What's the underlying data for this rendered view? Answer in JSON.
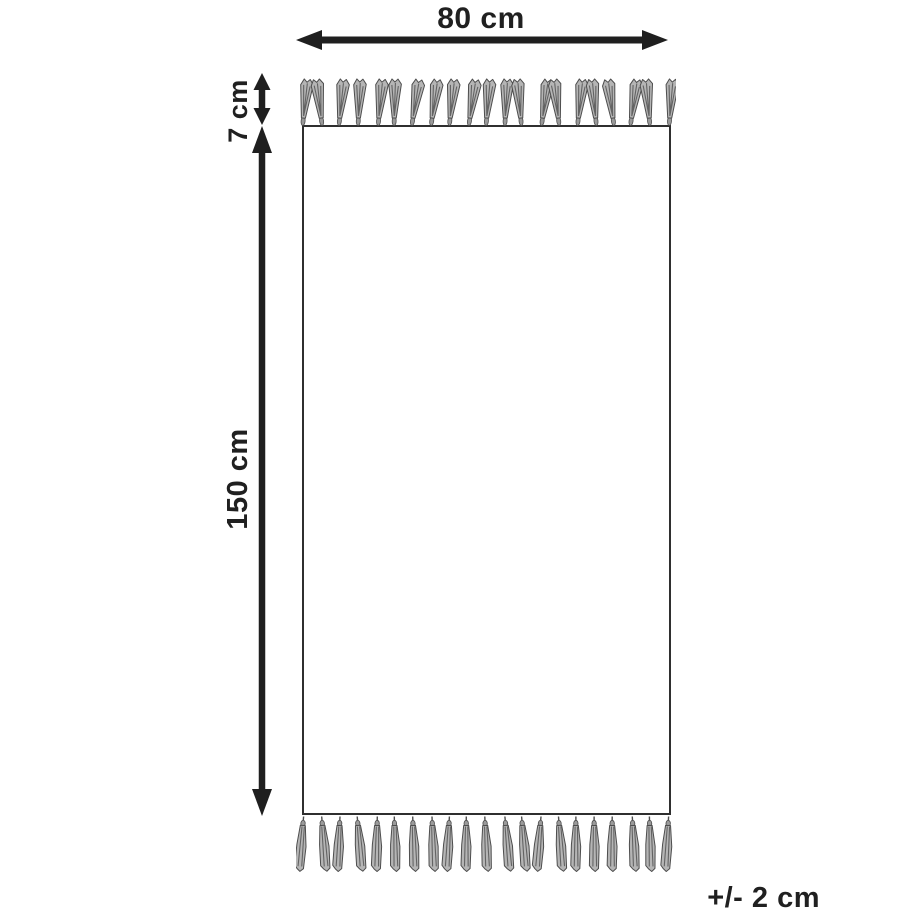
{
  "diagram": {
    "kind": "rug-dimension-diagram",
    "labels": {
      "width": "80 cm",
      "fringe": "7 cm",
      "height": "150 cm",
      "tolerance": "+/- 2 cm"
    },
    "fringe": {
      "count_top": 21,
      "count_bottom": 21
    },
    "colors": {
      "line": "#1f1f1f",
      "text": "#202020",
      "rug_border": "#2f2f2f",
      "rug_fill": "#ffffff",
      "background": "#ffffff",
      "tassel_fill": "#b5b5b5",
      "tassel_knot": "#9a9a9a",
      "tassel_shade": "#636363",
      "tassel_outline": "#4d4d4d"
    }
  }
}
